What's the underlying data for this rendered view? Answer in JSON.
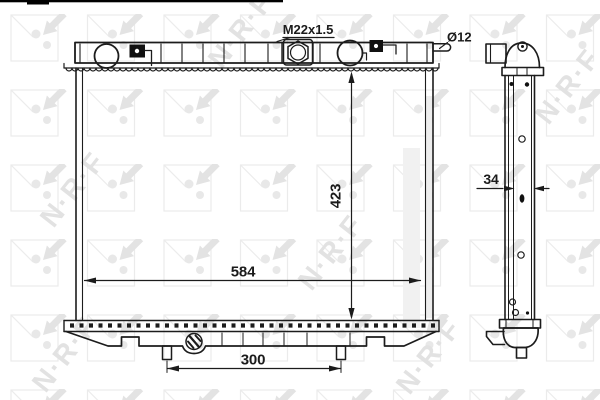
{
  "drawing": {
    "labels": {
      "thread": "M22x1.5",
      "outlet_diameter": "Ø12",
      "core_height": "423",
      "core_width": "584",
      "pin_spacing": "300",
      "core_depth": "34"
    },
    "watermark": {
      "text": "N·R·F",
      "color": "#e2e2e2"
    },
    "line_color": "#1c1c1c",
    "background": "#ffffff"
  }
}
